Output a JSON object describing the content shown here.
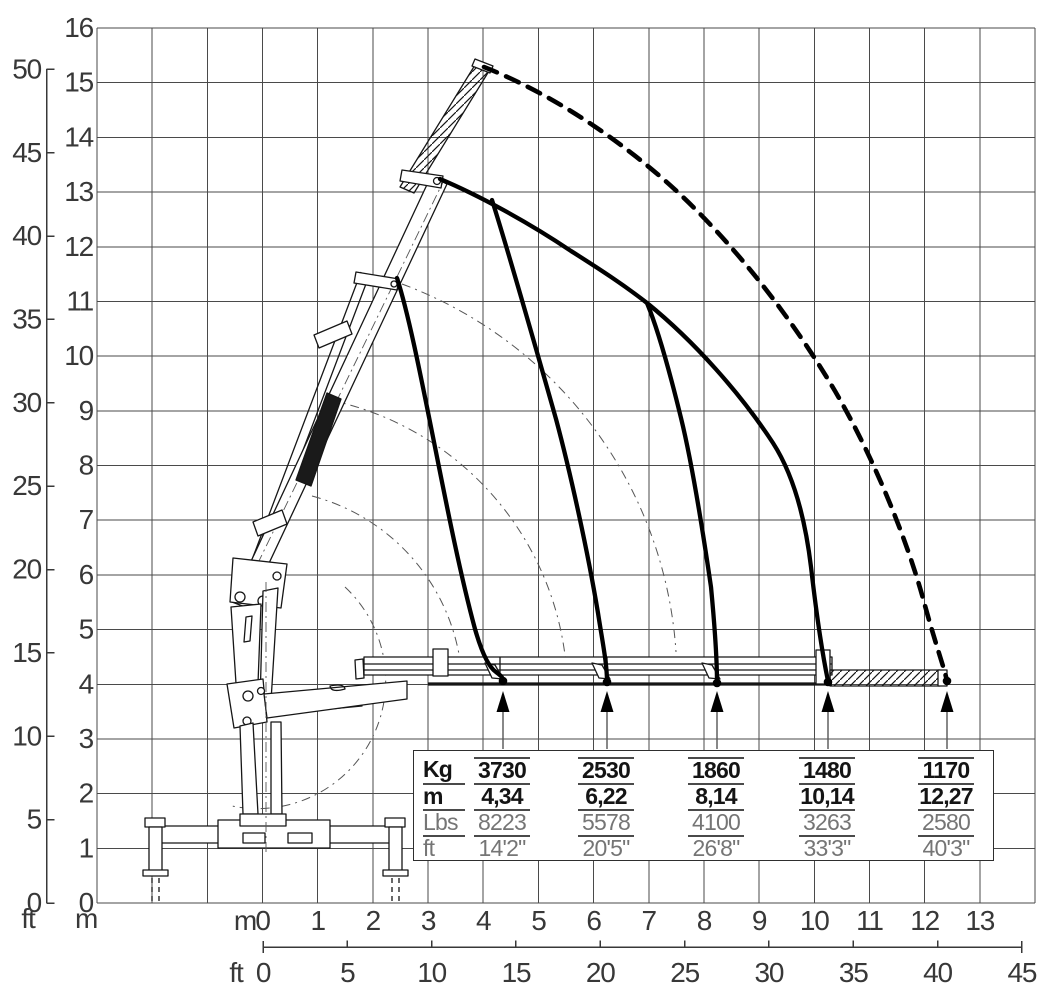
{
  "axes": {
    "left_ft": {
      "unit": "ft",
      "ticks": [
        "50",
        "45",
        "40",
        "35",
        "30",
        "25",
        "20",
        "15",
        "10",
        "5",
        "0"
      ]
    },
    "left_m": {
      "unit": "m",
      "ticks": [
        "16",
        "15",
        "14",
        "13",
        "12",
        "11",
        "10",
        "9",
        "8",
        "7",
        "6",
        "5",
        "4",
        "3",
        "2",
        "1",
        "0"
      ]
    },
    "bottom_m": {
      "unit": "m",
      "ticks": [
        "0",
        "1",
        "2",
        "3",
        "4",
        "5",
        "6",
        "7",
        "8",
        "9",
        "10",
        "11",
        "12",
        "13"
      ]
    },
    "bottom_ft": {
      "unit": "ft",
      "ticks": [
        "0",
        "5",
        "10",
        "15",
        "20",
        "25",
        "30",
        "35",
        "40",
        "45"
      ]
    }
  },
  "load_table": {
    "row_labels": [
      "Kg",
      "m",
      "Lbs",
      "ft"
    ],
    "columns": [
      {
        "kg": "3730",
        "m": "4,34",
        "lbs": "8223",
        "ft": "14'2\""
      },
      {
        "kg": "2530",
        "m": "6,22",
        "lbs": "5578",
        "ft": "20'5\""
      },
      {
        "kg": "1860",
        "m": "8,14",
        "lbs": "4100",
        "ft": "26'8\""
      },
      {
        "kg": "1480",
        "m": "10,14",
        "lbs": "3263",
        "ft": "33'3\""
      },
      {
        "kg": "1170",
        "m": "12,27",
        "lbs": "2580",
        "ft": "40'3\""
      }
    ]
  },
  "chart_data": {
    "type": "line",
    "x_outreach_m": [
      4.34,
      6.22,
      8.14,
      10.14,
      12.27
    ],
    "series": [
      {
        "name": "capacity_kg",
        "values": [
          3730,
          2530,
          1860,
          1480,
          1170
        ]
      },
      {
        "name": "capacity_lbs",
        "values": [
          8223,
          5578,
          4100,
          3263,
          2580
        ]
      }
    ],
    "outreach_ft_labels": [
      "14'2\"",
      "20'5\"",
      "26'8\"",
      "33'3\"",
      "40'3\""
    ],
    "x_axis_m_range": [
      0,
      13
    ],
    "y_axis_m_range": [
      0,
      16
    ],
    "x_axis_ft_range": [
      0,
      45
    ],
    "y_axis_ft_range": [
      0,
      50
    ],
    "grid": "on",
    "legend_position": "none"
  }
}
